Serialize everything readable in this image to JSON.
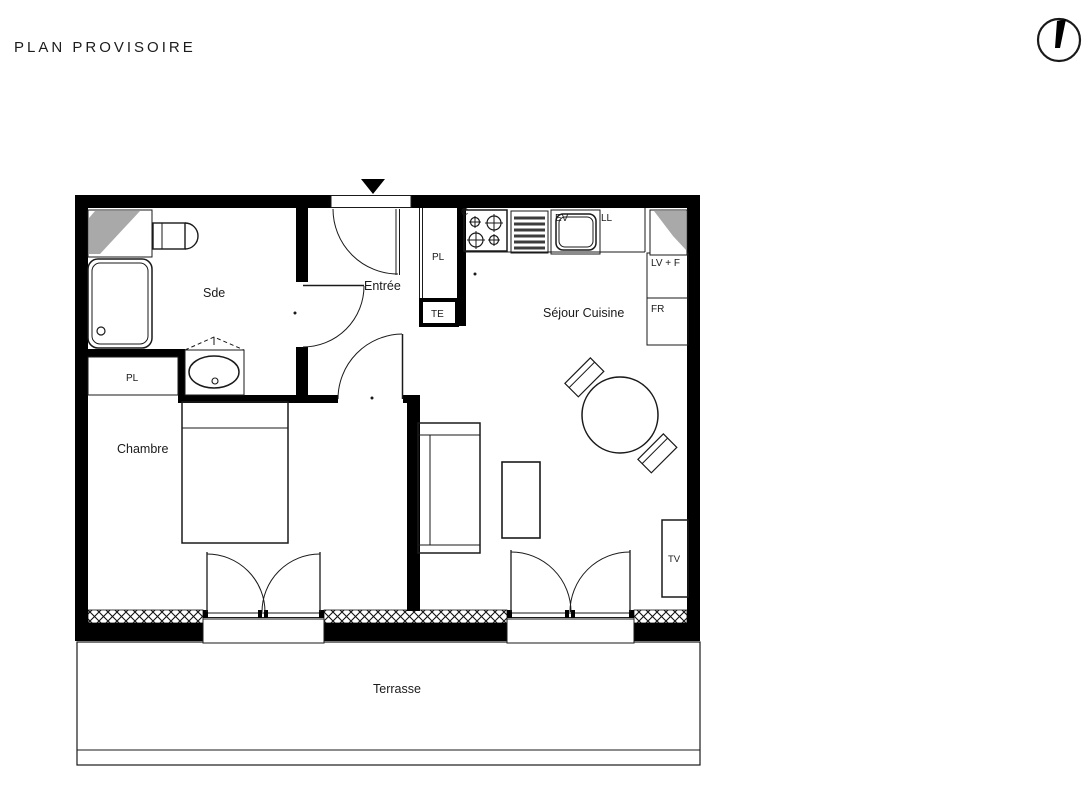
{
  "title": "PLAN PROVISOIRE",
  "icons": {
    "north_arrow": "north-arrow-icon",
    "entrance_marker": "entrance-triangle-icon"
  },
  "rooms": {
    "bathroom": "Sde",
    "entrance": "Entrée",
    "living_kitchen": "Séjour Cuisine",
    "bedroom": "Chambre",
    "terrace": "Terrasse"
  },
  "fixtures": {
    "closet_bathroom": "PL",
    "closet_entrance": "PL",
    "electrical_panel": "TE",
    "cooktop": "C",
    "kitchen_sink": "EV",
    "washing_machine": "LL",
    "dishwasher_oven": "LV + F",
    "fridge": "FR",
    "tv_unit": "TV"
  },
  "colors": {
    "wall": "#000000",
    "line": "#1a1a1a",
    "duct_gray": "#a9a9a9",
    "background": "#ffffff"
  }
}
